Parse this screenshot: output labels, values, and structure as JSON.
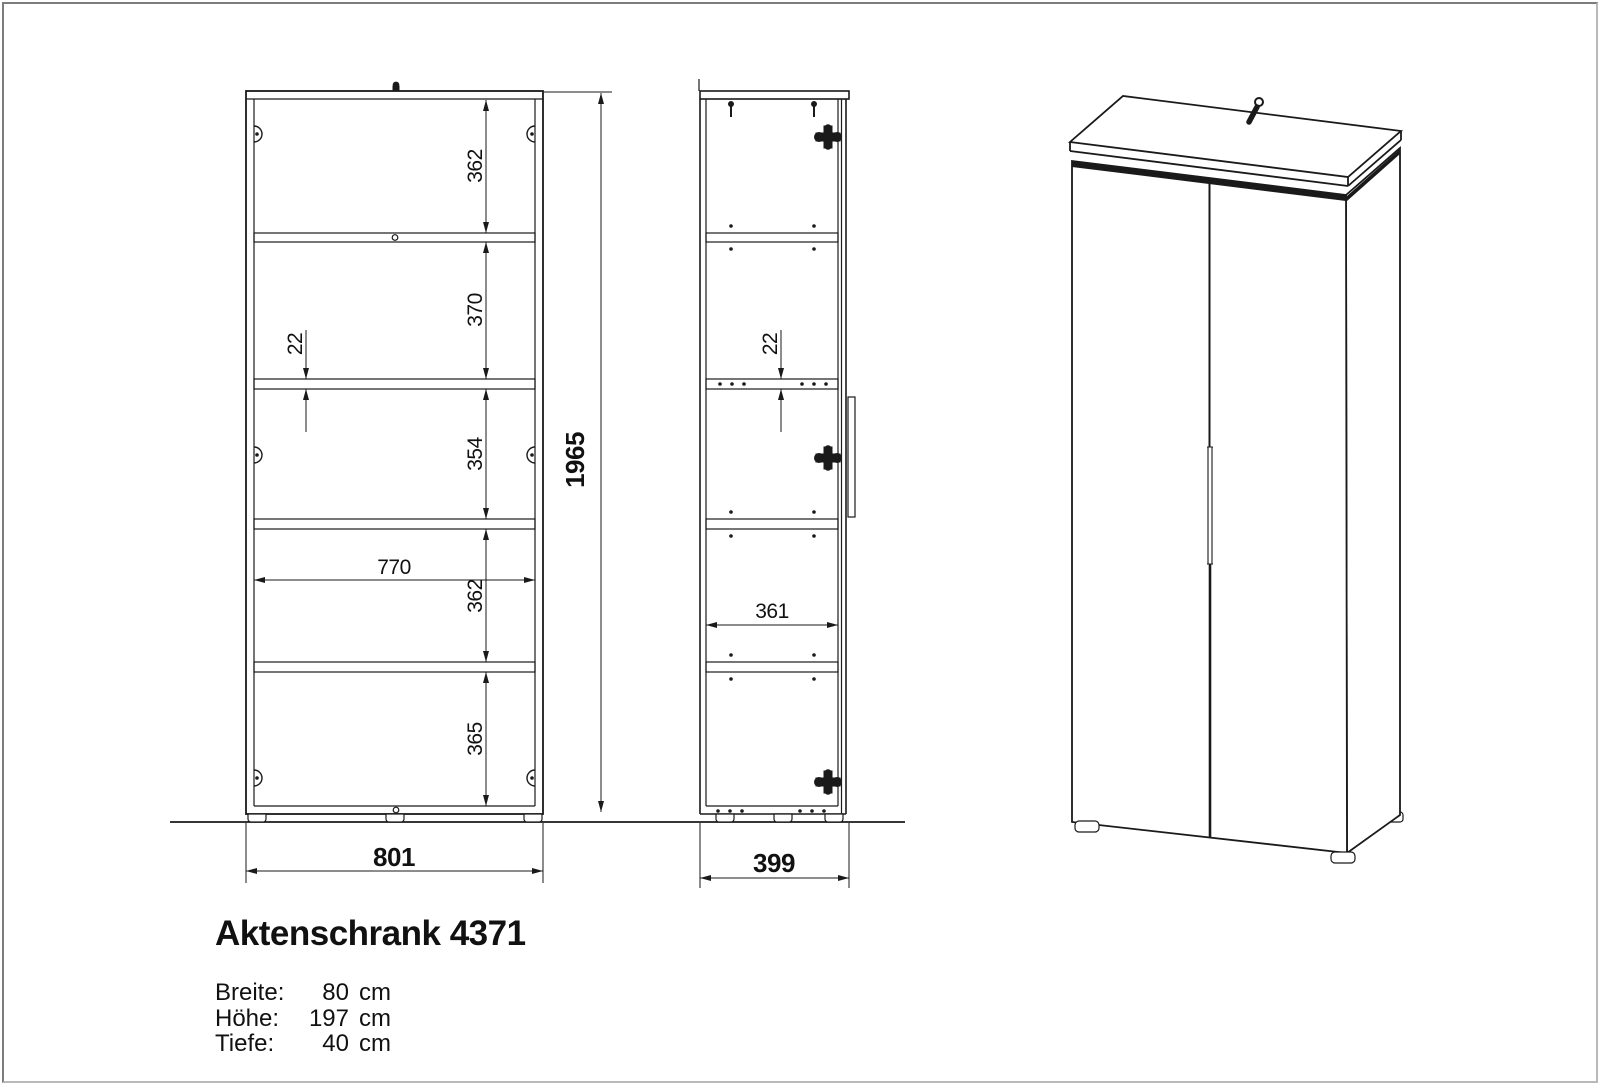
{
  "drawing": {
    "views": {
      "front": {
        "section_heights": [
          "362",
          "370",
          "354",
          "362",
          "365"
        ],
        "shelf_thickness": "22",
        "inner_width": "770",
        "total_height": "1965",
        "outer_width": "801"
      },
      "side": {
        "shelf_thickness": "22",
        "inner_depth": "361",
        "outer_depth": "399"
      }
    },
    "title": "Aktenschrank 4371",
    "specs": [
      {
        "label": "Breite:",
        "number": "80",
        "unit": "cm"
      },
      {
        "label": "Höhe:",
        "number": "197",
        "unit": "cm"
      },
      {
        "label": "Tiefe:",
        "number": "40",
        "unit": "cm"
      }
    ]
  }
}
